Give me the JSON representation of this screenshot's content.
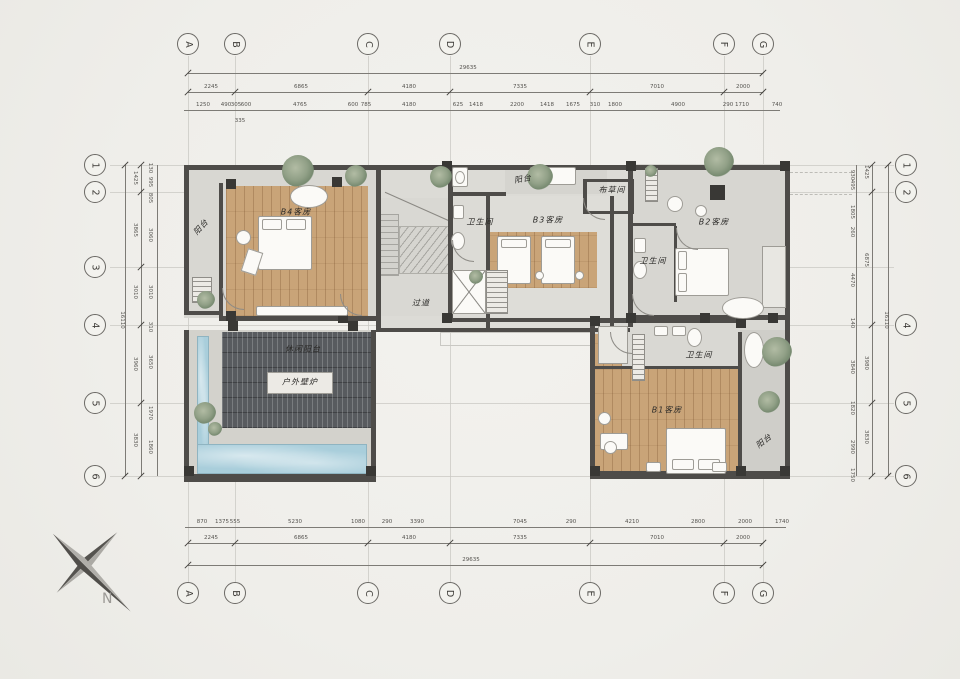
{
  "compass": {
    "label": "N"
  },
  "grid": {
    "columns": [
      "A",
      "B",
      "C",
      "D",
      "E",
      "F",
      "G"
    ],
    "rows": [
      "1",
      "2",
      "3",
      "4",
      "5",
      "6"
    ],
    "rows_right": [
      "1",
      "2",
      "4",
      "5",
      "6"
    ]
  },
  "dimensions": {
    "top": {
      "overall": "29635",
      "segments": [
        "2245",
        "6865",
        "4180",
        "7335",
        "7010",
        "2000"
      ],
      "details": [
        "1250",
        "490",
        "305",
        "600",
        "4765",
        "600",
        "785",
        "4180",
        "625",
        "1418",
        "2200",
        "1418",
        "1675",
        "310",
        "1800",
        "4900",
        "290",
        "1710",
        "740"
      ],
      "extra": "335"
    },
    "bottom": {
      "overall": "29635",
      "segments": [
        "2245",
        "6865",
        "4180",
        "7335",
        "7010",
        "2000"
      ],
      "details": [
        "870",
        "1375",
        "555",
        "5230",
        "1080",
        "290",
        "3390",
        "7045",
        "290",
        "4210",
        "2800",
        "2000",
        "1740"
      ]
    },
    "left": {
      "overall": "16110",
      "segments": [
        "1425",
        "3865",
        "3010",
        "3960",
        "3830"
      ],
      "details": [
        "130",
        "995",
        "805",
        "3060",
        "3010",
        "310",
        "3650",
        "1970",
        "1860"
      ]
    },
    "right": {
      "overall": "16110",
      "segments": [
        "1425",
        "6875",
        "3980",
        "3830"
      ],
      "details": [
        "930",
        "495",
        "1805",
        "260",
        "4470",
        "140",
        "3840",
        "1820",
        "2990",
        "1750"
      ]
    }
  },
  "rooms": [
    {
      "id": "balcony-b4",
      "label": "阳台"
    },
    {
      "id": "bedroom-b4",
      "label": "B4客房"
    },
    {
      "id": "bath-b3",
      "label": "卫生间"
    },
    {
      "id": "bedroom-b3",
      "label": "B3客房"
    },
    {
      "id": "balcony-b3",
      "label": "阳台"
    },
    {
      "id": "linen-room",
      "label": "布草间"
    },
    {
      "id": "bath-b2",
      "label": "卫生间"
    },
    {
      "id": "bedroom-b2",
      "label": "B2客房"
    },
    {
      "id": "corridor",
      "label": "过道"
    },
    {
      "id": "leisure-terrace",
      "label": "休闲阳台"
    },
    {
      "id": "outdoor-fireplace",
      "label": "户外壁炉"
    },
    {
      "id": "bath-b1",
      "label": "卫生间"
    },
    {
      "id": "bedroom-b1",
      "label": "B1客房"
    },
    {
      "id": "balcony-b1",
      "label": "阳台"
    }
  ],
  "colors": {
    "paper": "#f0efeb",
    "floor": "#dbdad5",
    "wood": "#c9a478",
    "pool": "#a9cedb",
    "deck": "#585b5f",
    "wall": "#4e4c49",
    "plant": "#8e9c84"
  }
}
